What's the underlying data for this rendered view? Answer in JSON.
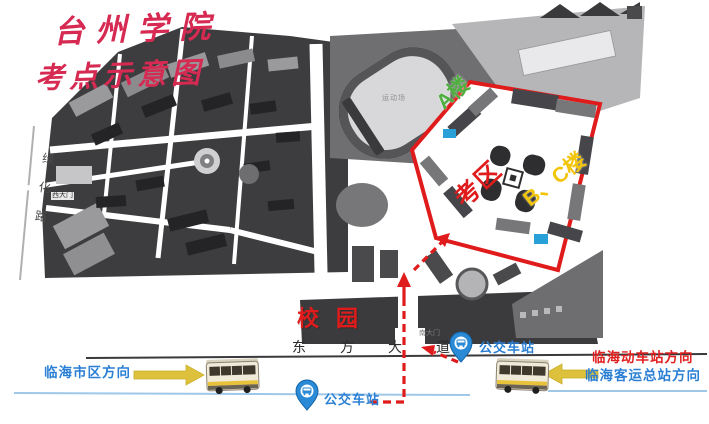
{
  "title": {
    "line1": "台州学院",
    "line2": "考点示意图"
  },
  "campus_map": {
    "green_road_label": "绿化路",
    "west_gate_label": "西大门",
    "stadium_label": "运动场",
    "south_gate_label": "南大门",
    "campus_label": "校园",
    "exam_area_label": "考区",
    "building_a_label": "A楼",
    "building_bc_label": "B、C楼"
  },
  "road": {
    "name": "东方大道"
  },
  "bus_stops": {
    "right_label": "公交车站",
    "bottom_label": "公交车站"
  },
  "directions": {
    "left": "临海市区方向",
    "right_line1": "临海动车站方向",
    "right_line2": "临海客运总站方向"
  },
  "colors": {
    "title_red": "#d62a52",
    "exam_red": "#e01b1b",
    "building_a_green": "#4fae3f",
    "building_bc_yellow": "#f3c50a",
    "blue_text": "#2a7fd4",
    "arrow_yellow": "#ddc13c",
    "map_dark": "#3d3d3f"
  }
}
